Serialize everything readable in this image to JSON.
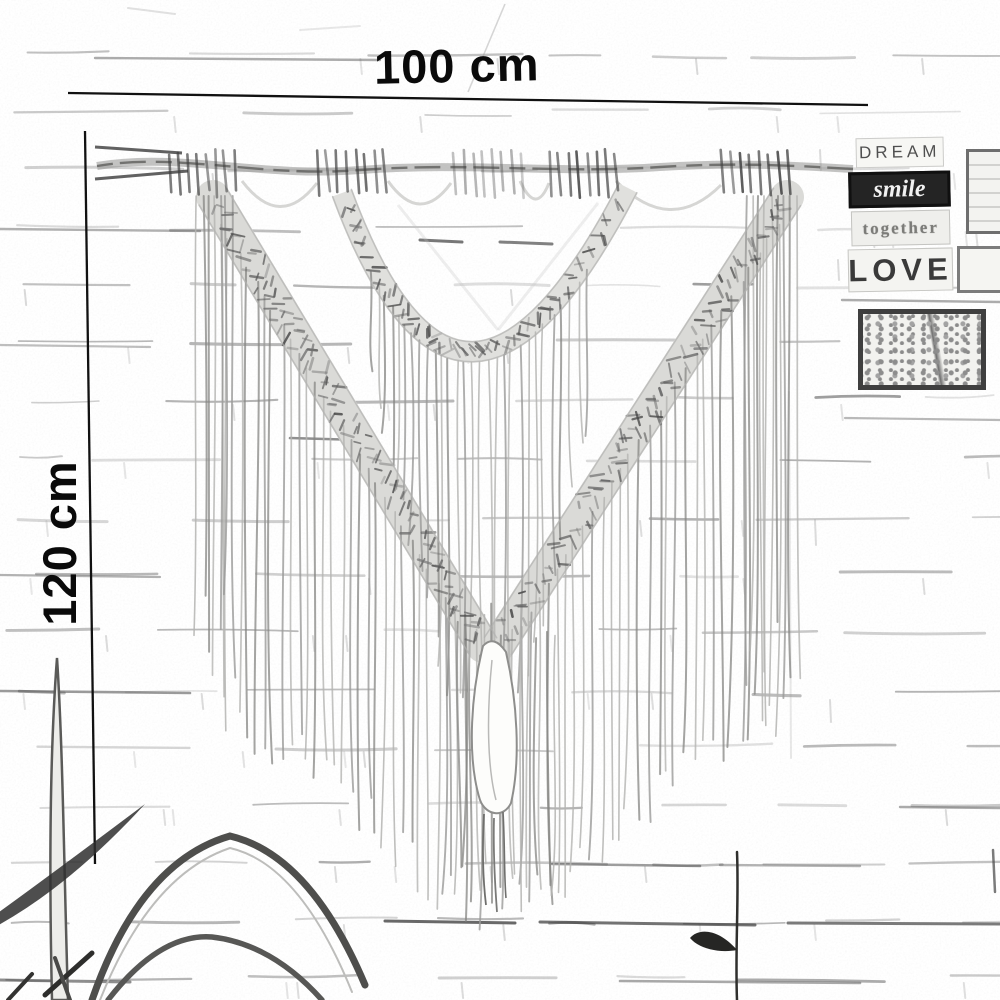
{
  "dimensions": {
    "width": {
      "label": "100 cm"
    },
    "height": {
      "label": "120 cm"
    }
  },
  "wall_signs": {
    "plaques": [
      {
        "id": "dream",
        "label": "DREAM"
      },
      {
        "id": "smile",
        "label": "smile"
      },
      {
        "id": "together",
        "label": "together"
      },
      {
        "id": "love",
        "label": "LOVE"
      }
    ]
  },
  "colors": {
    "ink": "#0d0d0d",
    "sketch_dark": "#3c3c3c",
    "sketch_mid": "#6f6f6f",
    "sketch_light": "#b5b5b5",
    "paper": "#ffffff",
    "plaque_dark_bg": "#242424",
    "plaque_light_bg": "#f6f6f3"
  }
}
